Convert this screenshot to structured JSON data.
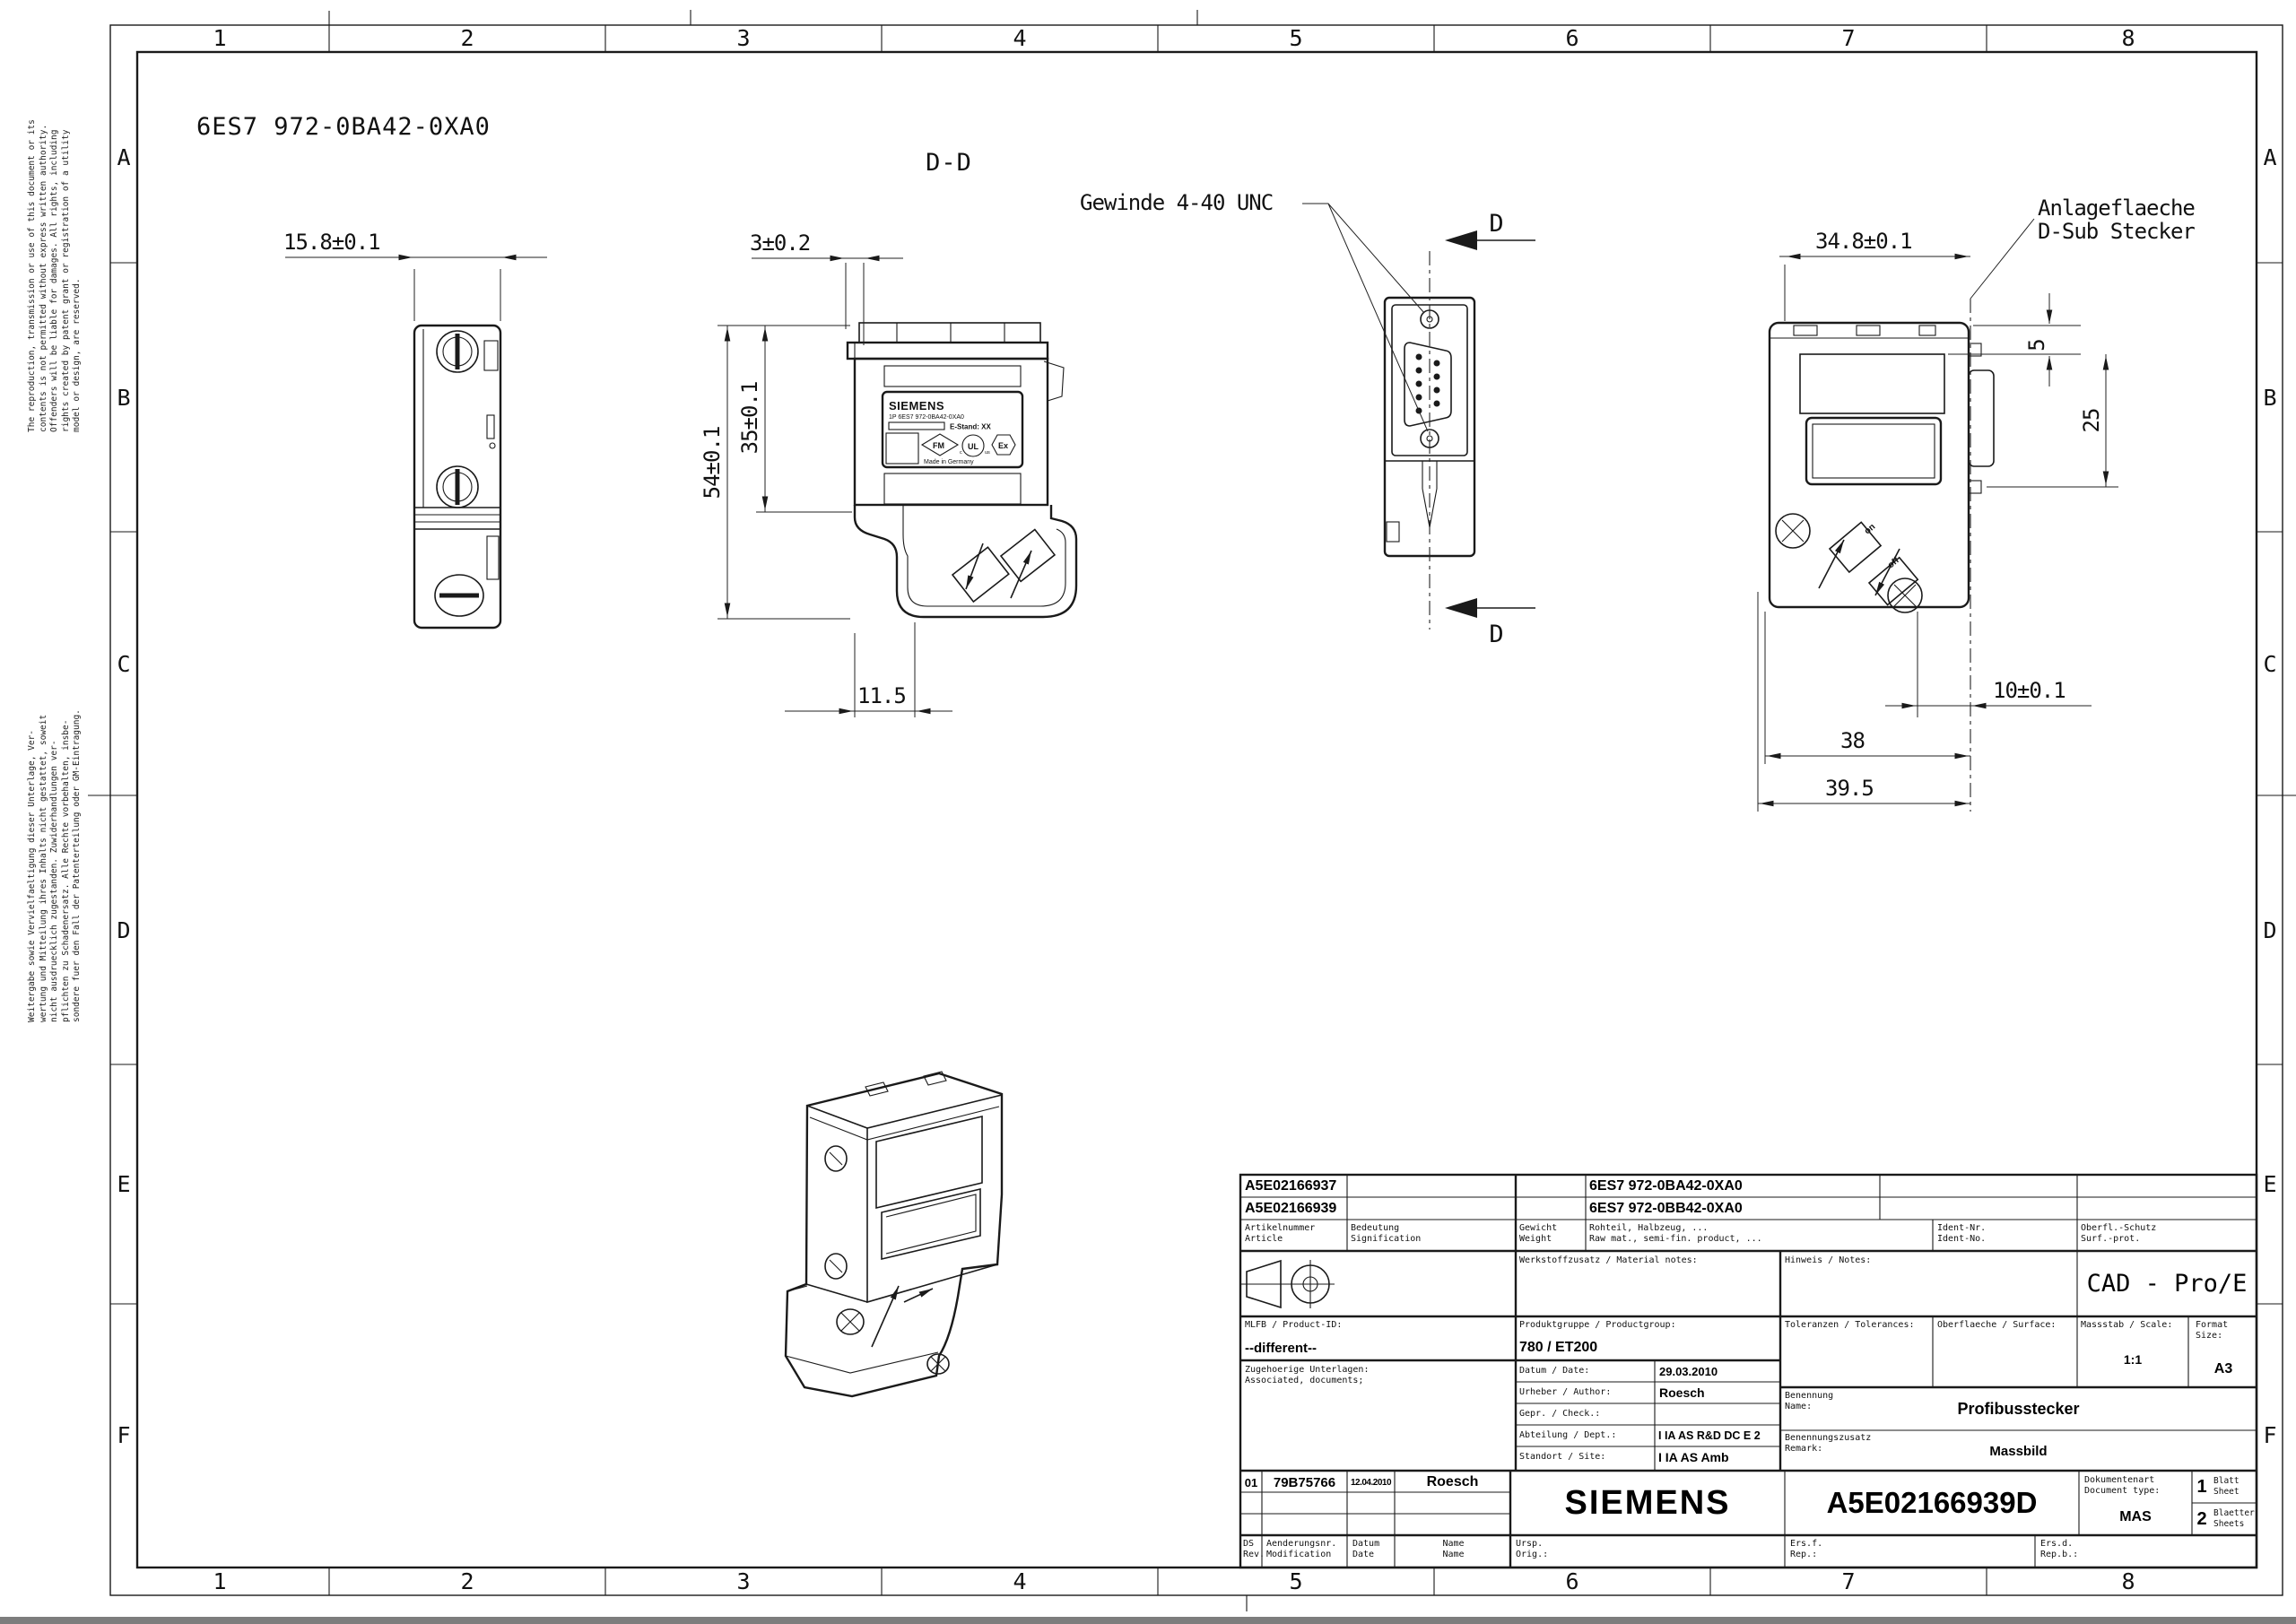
{
  "sheet": {
    "heading_part_number": "6ES7 972-0BA42-0XA0",
    "section_label": "D-D",
    "grid_columns": [
      "1",
      "2",
      "3",
      "4",
      "5",
      "6",
      "7",
      "8"
    ],
    "grid_rows": [
      "A",
      "B",
      "C",
      "D",
      "E",
      "F"
    ],
    "disclaimer_en": "The reproduction, transmission or use of this document or its\ncontents is not permitted without express written authority.\nOffenders will be liable for damages. All rights, including\nrights created by patent grant or registration of a utility\nmodel or design, are reserved.",
    "disclaimer_de": "Weitergabe sowie Vervielfaeltigung dieser Unterlage, Ver-\nwertung und Mitteilung ihres Inhalts nicht gestattet, soweit\nnicht ausdruecklich zugestanden. Zuwiderhandlungen ver-\npflichten zu Schadenersatz. Alle Rechte vorbehalten, insbe-\nsondere fuer den Fall der Patenterteilung oder GM-Eintragung."
  },
  "annotations": {
    "thread_note": "Gewinde 4-40 UNC",
    "contact_face_note": [
      "Anlageflaeche",
      "D-Sub Stecker"
    ],
    "section_arrow": "D"
  },
  "dimensions": {
    "side_width": "15.8±0.1",
    "cap_lip": "3±0.2",
    "total_height": "54±0.1",
    "upper_height": "35±0.1",
    "cable_exit_offset": "11.5",
    "body_width": "34.8±0.1",
    "vent_offset": "5",
    "vent_height": "25",
    "face_offset": "10±0.1",
    "body_depth": "38",
    "total_depth": "39.5"
  },
  "device_label": {
    "brand": "SIEMENS",
    "order_line": "1P  6ES7 972-0BA42-0XA0",
    "estand": "E-Stand: XX",
    "made_in": "Made in Germany",
    "fm": "FM",
    "ul": "UL",
    "ul_c": "c",
    "ul_us": "us",
    "ex": "Ex",
    "switch_on": "on",
    "switch_off": "off"
  },
  "title_block": {
    "articles": [
      {
        "number": "A5E02166937",
        "mlfb": "6ES7  972-0BA42-0XA0"
      },
      {
        "number": "A5E02166939",
        "mlfb": "6ES7  972-0BB42-0XA0"
      }
    ],
    "col_headers": {
      "article": [
        "Artikelnummer",
        "Article"
      ],
      "meaning": [
        "Bedeutung",
        "Signification"
      ],
      "weight": [
        "Gewicht",
        "Weight"
      ],
      "raw": [
        "Rohteil, Halbzeug, ...",
        "Raw mat., semi-fin. product, ..."
      ],
      "ident": [
        "Ident-Nr.",
        "Ident-No."
      ],
      "surf": [
        "Oberfl.-Schutz",
        "Surf.-prot."
      ]
    },
    "material_notes_label": "Werkstoffzusatz / Material notes:",
    "notes_label": "Hinweis / Notes:",
    "cad_system": "CAD - Pro/E",
    "product_id_label": "MLFB / Product-ID:",
    "product_id": "--different--",
    "product_group_label": "Produktgruppe / Productgroup:",
    "product_group": "780 / ET200",
    "tolerances_label": "Toleranzen / Tolerances:",
    "surface_label": "Oberflaeche / Surface:",
    "scale_label": "Massstab / Scale:",
    "scale": "1:1",
    "format_label": [
      "Format",
      "Size:"
    ],
    "format": "A3",
    "associated_label": [
      "Zugehoerige Unterlagen:",
      "Associated, documents;"
    ],
    "rows": {
      "date_label": "Datum / Date:",
      "date": "29.03.2010",
      "author_label": "Urheber / Author:",
      "author": "Roesch",
      "checked_label": "Gepr. / Check.:",
      "dept_label": "Abteilung / Dept.:",
      "dept": "I IA AS R&D DC E 2",
      "site_label": "Standort / Site:",
      "site": "I IA AS Amb"
    },
    "name_label": [
      "Benennung",
      "Name:"
    ],
    "name": "Profibusstecker",
    "remark_label": [
      "Benennungszusatz",
      "Remark:"
    ],
    "remark": "Massbild",
    "revision": {
      "rev": "01",
      "change_no": "79B75766",
      "date": "12.04.2010",
      "name": "Roesch"
    },
    "brand": "SIEMENS",
    "document_number": "A5E02166939D",
    "doc_type_label": [
      "Dokumentenart",
      "Document type:"
    ],
    "doc_type": "MAS",
    "sheet_no": "1",
    "sheet_label": [
      "Blatt",
      "Sheet"
    ],
    "sheets_no": "2",
    "sheets_label": [
      "Blaetter",
      "Sheets"
    ],
    "footer": {
      "rev": [
        "DS",
        "Rev."
      ],
      "modification": [
        "Aenderungsnr.",
        "Modification"
      ],
      "date": [
        "Datum",
        "Date"
      ],
      "name": [
        "Name",
        "Name"
      ],
      "orig": [
        "Ursp.",
        "Orig.:"
      ],
      "ersf": [
        "Ers.f.",
        "Rep.:"
      ],
      "ersd": [
        "Ers.d.",
        "Rep.b.:"
      ]
    }
  }
}
